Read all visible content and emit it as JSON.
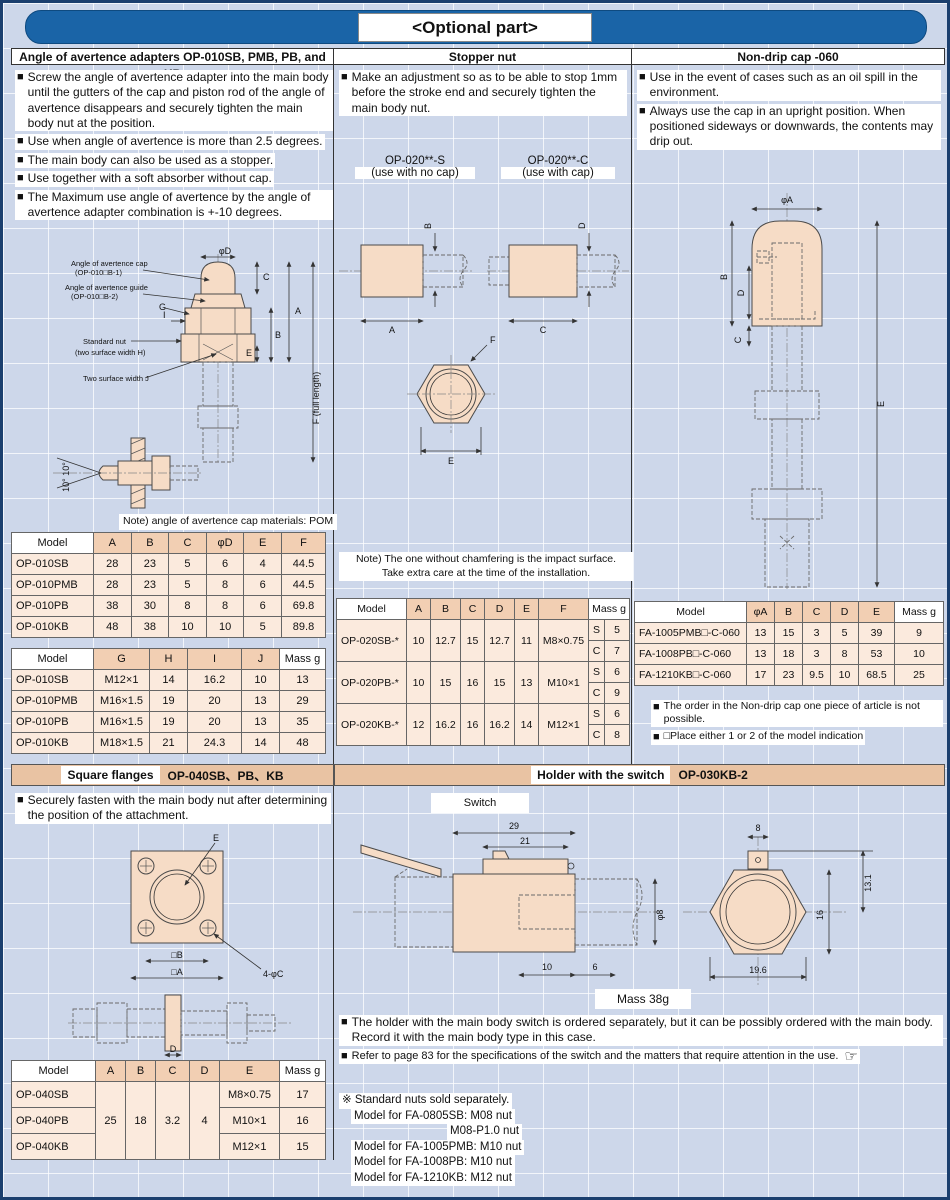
{
  "glyphs": {
    "bullet": "■",
    "pointing_hand": "☞"
  },
  "header": {
    "title": "<Optional part>"
  },
  "left": {
    "title": "Angle of avertence adapters OP-010SB, PMB, PB, and KB",
    "bullets": [
      "Screw the angle of avertence adapter into the main body until the gutters of the cap and piston rod of the angle of avertence disappears and securely tighten the main body nut at the position.",
      "Use when angle of avertence is more than 2.5 degrees.",
      "The main body can also be used as a stopper.",
      "Use together with a soft absorber without cap.",
      "The Maximum use angle of avertence by the angle of avertence adapter combination is +-10 degrees."
    ],
    "diagram": {
      "cap_label_1": "Angle of avertence cap",
      "cap_label_2": "(OP-010□B-1)",
      "guide_label_1": "Angle of avertence guide",
      "guide_label_2": "(OP-010□B-2)",
      "g": "G",
      "i": "I",
      "nut_label_1": "Standard nut",
      "nut_label_2": "(two surface width H)",
      "j_label": "Two surface width J",
      "phi_d": "φD",
      "a": "A",
      "b": "B",
      "c": "C",
      "e": "E",
      "f": "F (full length)",
      "angle": "10° 10°"
    },
    "note": "Note) angle of avertence cap materials: POM",
    "dim_table": {
      "headers": [
        "Model",
        "A",
        "B",
        "C",
        "φD",
        "E",
        "F"
      ],
      "rows": [
        [
          "OP-010SB",
          "28",
          "23",
          "5",
          "6",
          "4",
          "44.5"
        ],
        [
          "OP-010PMB",
          "28",
          "23",
          "5",
          "8",
          "6",
          "44.5"
        ],
        [
          "OP-010PB",
          "38",
          "30",
          "8",
          "8",
          "6",
          "69.8"
        ],
        [
          "OP-010KB",
          "48",
          "38",
          "10",
          "10",
          "5",
          "89.8"
        ]
      ]
    },
    "thread_table": {
      "headers": [
        "Model",
        "G",
        "H",
        "I",
        "J",
        "Mass g"
      ],
      "rows": [
        [
          "OP-010SB",
          "M12×1",
          "14",
          "16.2",
          "10",
          "13"
        ],
        [
          "OP-010PMB",
          "M16×1.5",
          "19",
          "20",
          "13",
          "29"
        ],
        [
          "OP-010PB",
          "M16×1.5",
          "19",
          "20",
          "13",
          "35"
        ],
        [
          "OP-010KB",
          "M18×1.5",
          "21",
          "24.3",
          "14",
          "48"
        ]
      ]
    }
  },
  "flange": {
    "band_title": "Square flanges",
    "band_models": "OP-040SB、PB、KB",
    "bullet": "Securely fasten with the main body nut after determining the position of the attachment.",
    "diagram": {
      "e": "E",
      "b": "□B",
      "a": "□A",
      "c": "4-φC",
      "d": "D"
    },
    "table": {
      "headers": [
        "Model",
        "A",
        "B",
        "C",
        "D",
        "E",
        "Mass g"
      ],
      "shared": {
        "a": "25",
        "b": "18",
        "c": "3.2",
        "d": "4"
      },
      "rows": [
        [
          "OP-040SB",
          "M8×0.75",
          "17"
        ],
        [
          "OP-040PB",
          "M10×1",
          "16"
        ],
        [
          "OP-040KB",
          "M12×1",
          "15"
        ]
      ]
    }
  },
  "middle": {
    "title": "Stopper nut",
    "bullet": "Make an adjustment so as to be able to stop 1mm before the stroke end and securely tighten the main body nut.",
    "variant_s_model": "OP-020**-S",
    "variant_s_sub": "(use with no cap)",
    "variant_c_model": "OP-020**-C",
    "variant_c_sub": "(use with cap)",
    "diagram": {
      "a": "A",
      "b": "B",
      "c": "C",
      "d": "D",
      "e": "E",
      "f": "F"
    },
    "note_1": "Note) The one without chamfering is the impact surface.",
    "note_2": "Take extra care at the time of the installation.",
    "table": {
      "headers": [
        "Model",
        "A",
        "B",
        "C",
        "D",
        "E",
        "F",
        "Mass g"
      ],
      "sub_s": "S",
      "sub_c": "C",
      "rows": [
        {
          "model": "OP-020SB-*",
          "a": "10",
          "b": "12.7",
          "c": "15",
          "d": "12.7",
          "e": "11",
          "f": "M8×0.75",
          "mass_s": "5",
          "mass_c": "7"
        },
        {
          "model": "OP-020PB-*",
          "a": "10",
          "b": "15",
          "c": "16",
          "d": "15",
          "e": "13",
          "f": "M10×1",
          "mass_s": "6",
          "mass_c": "9"
        },
        {
          "model": "OP-020KB-*",
          "a": "12",
          "b": "16.2",
          "c": "16",
          "d": "16.2",
          "e": "14",
          "f": "M12×1",
          "mass_s": "6",
          "mass_c": "8"
        }
      ]
    }
  },
  "right": {
    "title": "Non-drip cap -060",
    "bullets": [
      "Use in the event of cases such as an oil spill in the environment.",
      "Always use the cap in an upright position. When positioned sideways or downwards, the contents may drip out."
    ],
    "diagram": {
      "phi_a": "φA",
      "b": "B",
      "d": "D",
      "c": "C",
      "e": "E"
    },
    "table": {
      "headers": [
        "Model",
        "φA",
        "B",
        "C",
        "D",
        "E",
        "Mass g"
      ],
      "rows": [
        [
          "FA-1005PMB□-C-060",
          "13",
          "15",
          "3",
          "5",
          "39",
          "9"
        ],
        [
          "FA-1008PB□-C-060",
          "13",
          "18",
          "3",
          "8",
          "53",
          "10"
        ],
        [
          "FA-1210KB□-C-060",
          "17",
          "23",
          "9.5",
          "10",
          "68.5",
          "25"
        ]
      ]
    },
    "notes": [
      "The order in the Non-drip cap one piece of article is not possible.",
      "□Place either 1 or 2 of the model indication"
    ]
  },
  "holder": {
    "band_title": "Holder with the switch",
    "band_model": "OP-030KB-2",
    "switch_label": "Switch",
    "side_dims": {
      "d29": "29",
      "d21": "21",
      "d8": "φ8",
      "d10": "10",
      "d6": "6"
    },
    "front_dims": {
      "d8": "8",
      "d131": "13.1",
      "d16": "16",
      "d196": "19.6"
    },
    "mass": "Mass 38g",
    "bullets": [
      "The holder with the main body switch is ordered separately, but it can be possibly ordered with the main body. Record it with the main body type in this case.",
      "Refer to page 83 for the specifications of the switch and the matters that require attention in the use."
    ]
  },
  "footnotes": {
    "lines": [
      "※ Standard nuts sold separately.",
      "Model for FA-0805SB: M08 nut",
      "M08-P1.0 nut",
      "Model for FA-1005PMB: M10 nut",
      "Model for FA-1008PB: M10 nut",
      "Model for FA-1210KB: M12 nut"
    ]
  }
}
